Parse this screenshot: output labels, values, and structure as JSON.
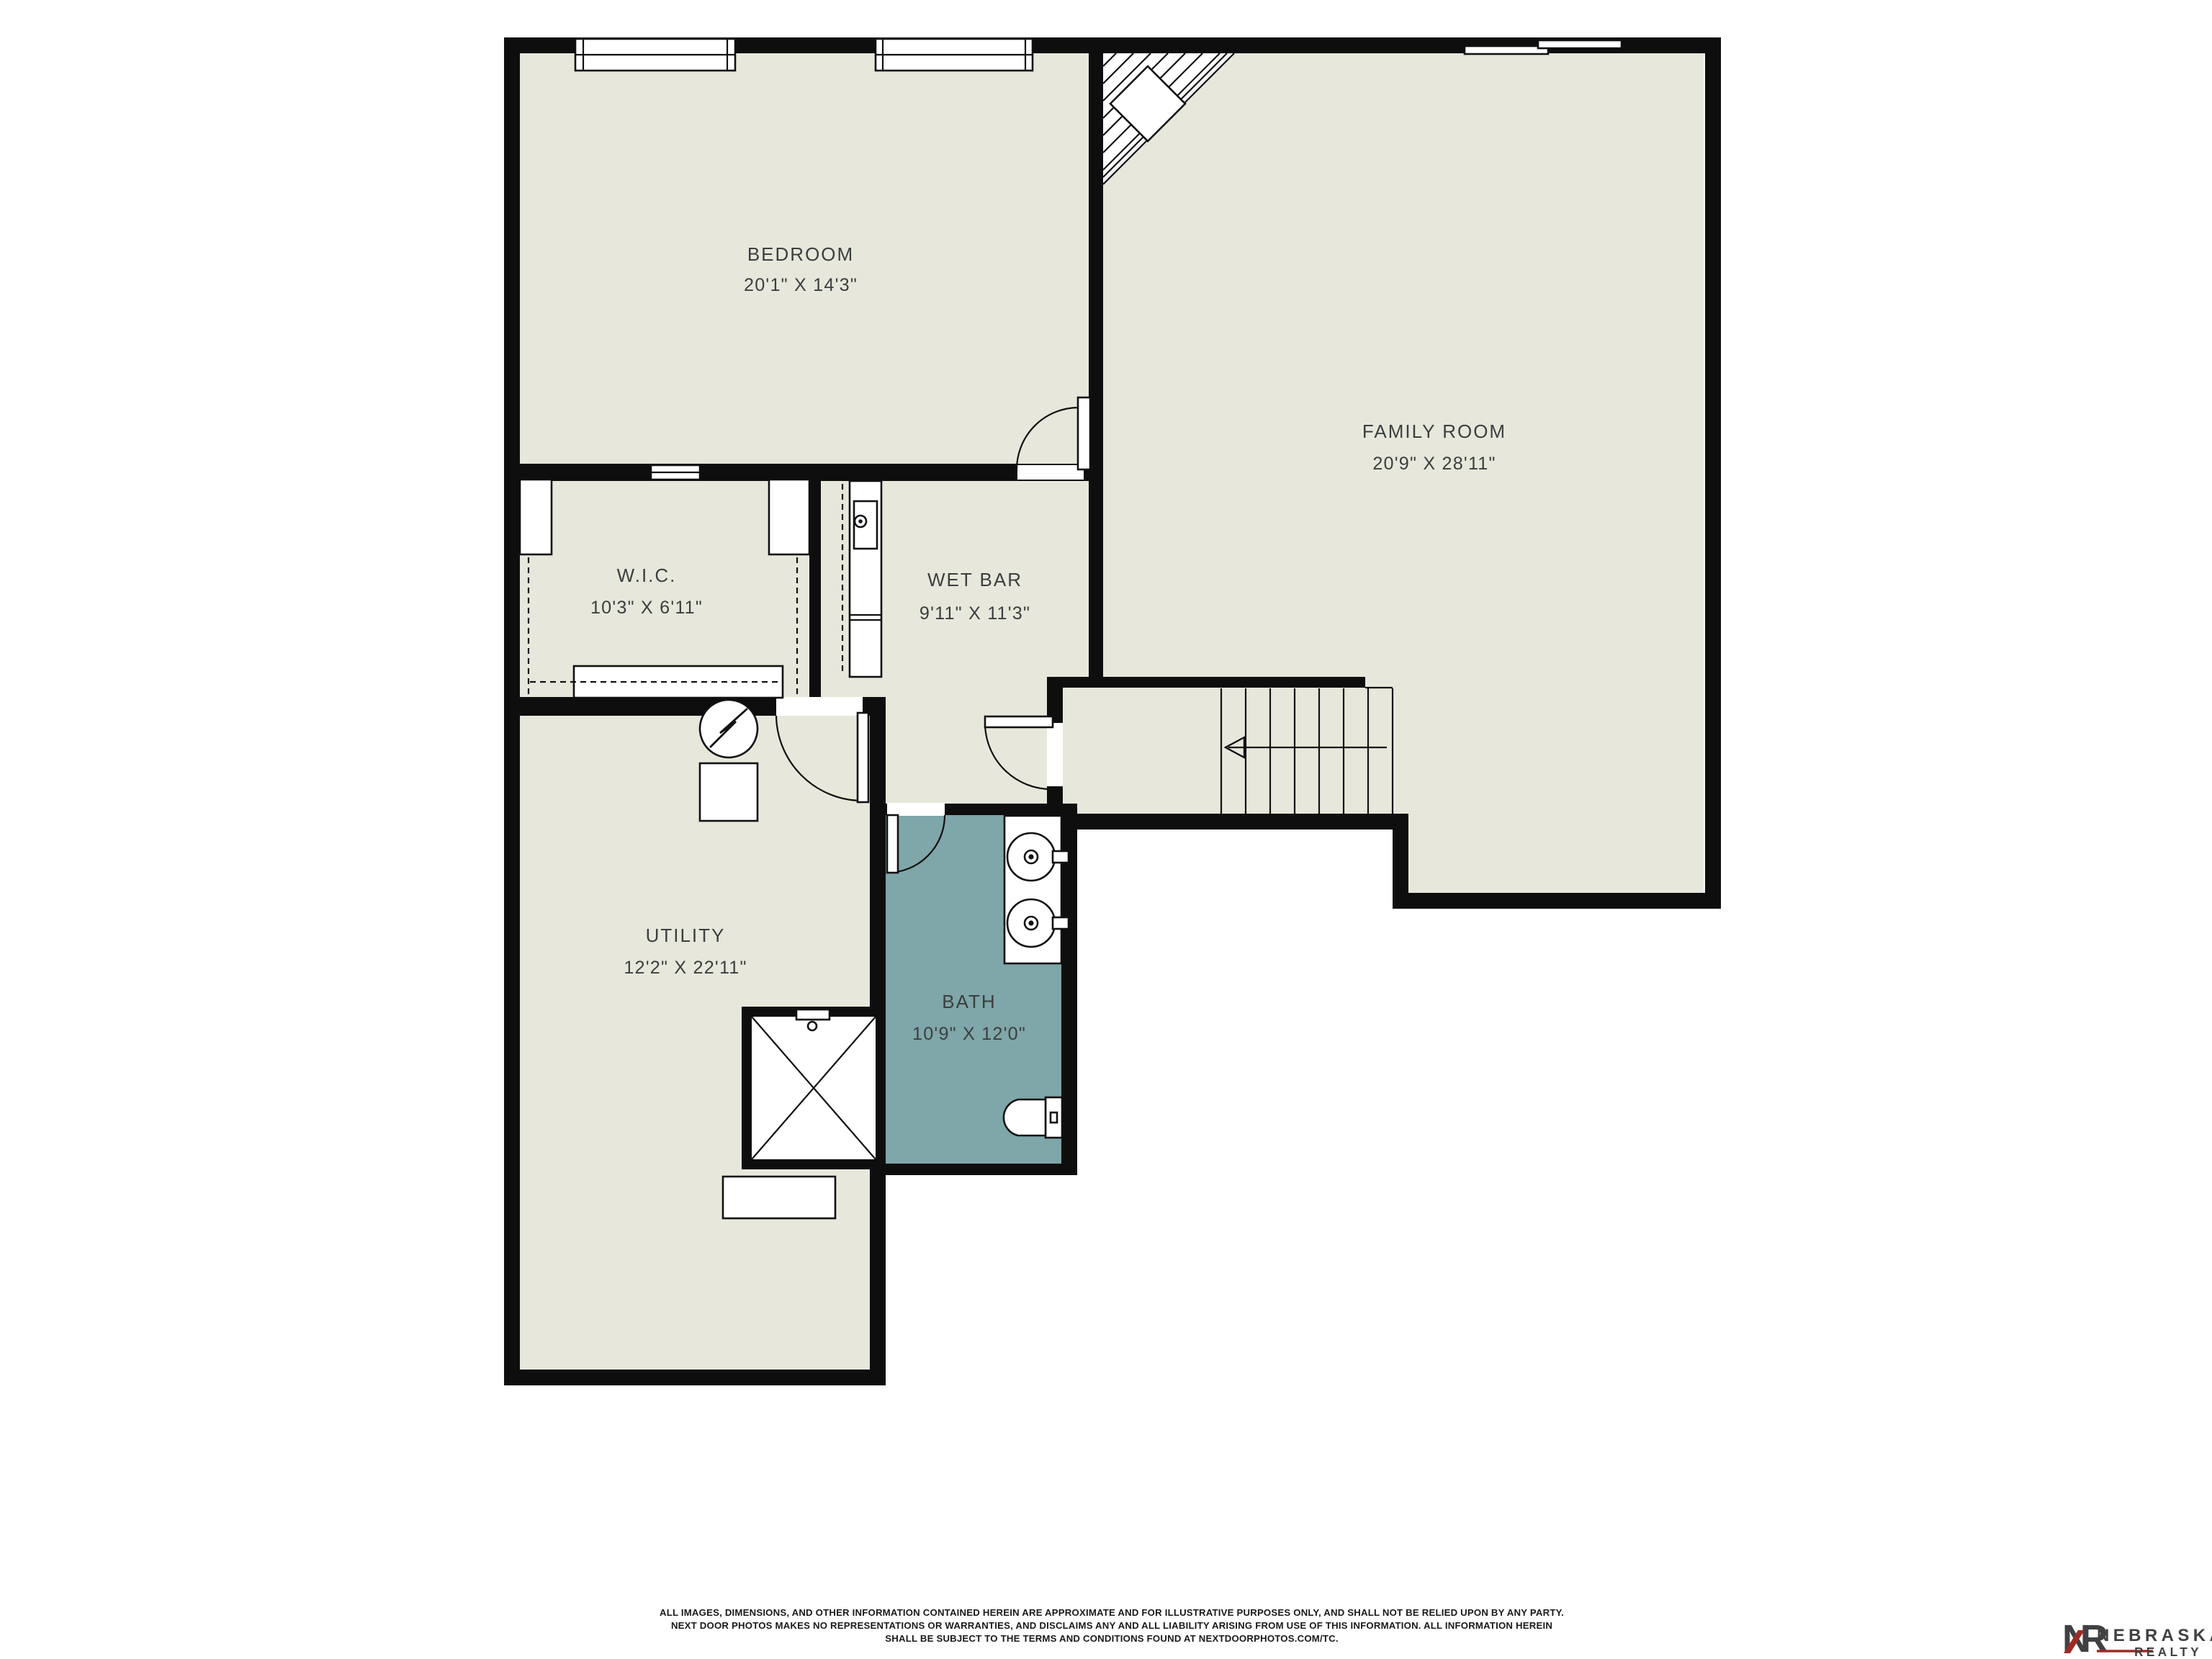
{
  "plan": {
    "rooms": [
      {
        "id": "bedroom",
        "label": "BEDROOM",
        "dims": "20'1\" X 14'3\""
      },
      {
        "id": "family-room",
        "label": "FAMILY ROOM",
        "dims": "20'9\" X 28'11\""
      },
      {
        "id": "wic",
        "label": "W.I.C.",
        "dims": "10'3\" X 6'11\""
      },
      {
        "id": "wet-bar",
        "label": "WET BAR",
        "dims": "9'11\" X 11'3\""
      },
      {
        "id": "utility",
        "label": "UTILITY",
        "dims": "12'2\" X 22'11\""
      },
      {
        "id": "bath",
        "label": "BATH",
        "dims": "10'9\" X 12'0\""
      }
    ],
    "colors": {
      "floor": "#E8E7DC",
      "bath_floor": "#7FA6A9",
      "wall": "#0E0E0E",
      "fixture_white": "#FFFFFF",
      "label_text": "#3A3F3E"
    }
  },
  "footer": {
    "disclaimer_lines": [
      "ALL IMAGES, DIMENSIONS, AND OTHER INFORMATION CONTAINED HEREIN ARE APPROXIMATE AND FOR ILLUSTRATIVE PURPOSES ONLY, AND SHALL NOT BE RELIED UPON BY ANY PARTY.",
      "NEXT DOOR PHOTOS MAKES NO REPRESENTATIONS OR WARRANTIES, AND DISCLAIMS ANY AND ALL LIABILITY ARISING FROM USE OF THIS INFORMATION. ALL INFORMATION HEREIN",
      "SHALL BE SUBJECT TO THE TERMS AND CONDITIONS FOUND AT NEXTDOORPHOTOS.COM/TC."
    ]
  },
  "brand": {
    "monogram": "NR",
    "name": "NEBRASKA",
    "division": "REALTY",
    "accent_red": "#9E2B25",
    "dark": "#414042"
  }
}
